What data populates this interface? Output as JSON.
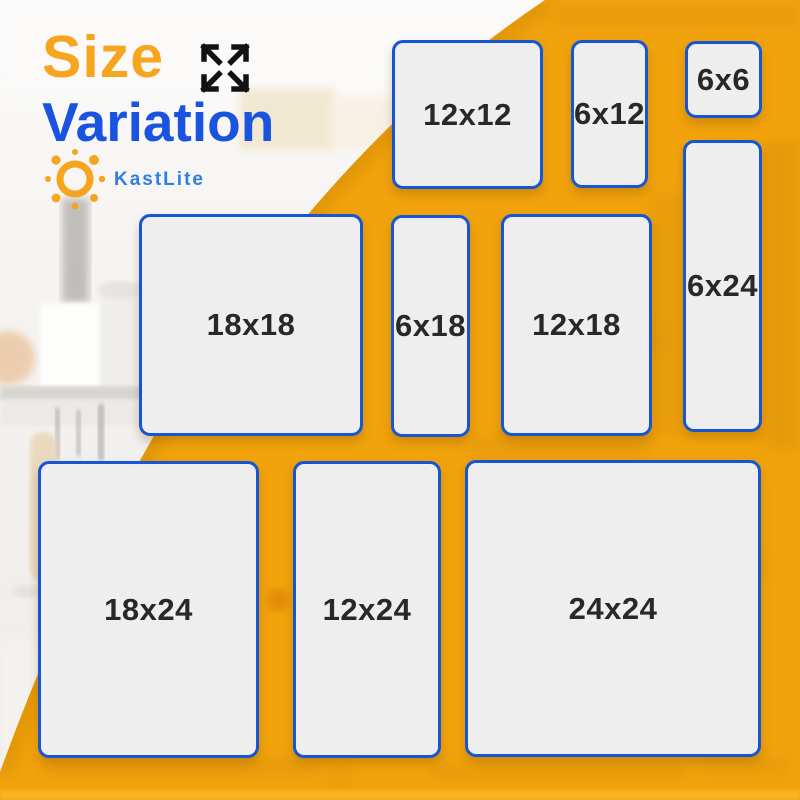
{
  "page": {
    "width": 800,
    "height": 800
  },
  "header": {
    "title_word1": "Size",
    "title_word2": "Variation",
    "expand_icon": "expand-arrows-icon",
    "brand": {
      "name": "KastLite",
      "icon": "sun-icon"
    }
  },
  "sizes": [
    {
      "label": "12x12",
      "x": 392,
      "y": 40,
      "w": 151,
      "h": 149
    },
    {
      "label": "6x12",
      "x": 571,
      "y": 40,
      "w": 77,
      "h": 148
    },
    {
      "label": "6x6",
      "x": 685,
      "y": 41,
      "w": 77,
      "h": 77
    },
    {
      "label": "6x24",
      "x": 683,
      "y": 140,
      "w": 79,
      "h": 292
    },
    {
      "label": "18x18",
      "x": 139,
      "y": 214,
      "w": 224,
      "h": 222
    },
    {
      "label": "6x18",
      "x": 391,
      "y": 215,
      "w": 79,
      "h": 222
    },
    {
      "label": "12x18",
      "x": 501,
      "y": 214,
      "w": 151,
      "h": 222
    },
    {
      "label": "18x24",
      "x": 38,
      "y": 461,
      "w": 221,
      "h": 297
    },
    {
      "label": "12x24",
      "x": 293,
      "y": 461,
      "w": 148,
      "h": 297
    },
    {
      "label": "24x24",
      "x": 465,
      "y": 460,
      "w": 296,
      "h": 297
    }
  ],
  "colors": {
    "yellow": "#F1A30C",
    "title_orange": "#F6A51E",
    "title_blue": "#1A53E0",
    "brand_blue": "#2E7EE4",
    "tile_border": "#1656D4",
    "tile_fill": "#EEEEEE",
    "label_color": "#282828",
    "arrow_black": "#121212"
  }
}
